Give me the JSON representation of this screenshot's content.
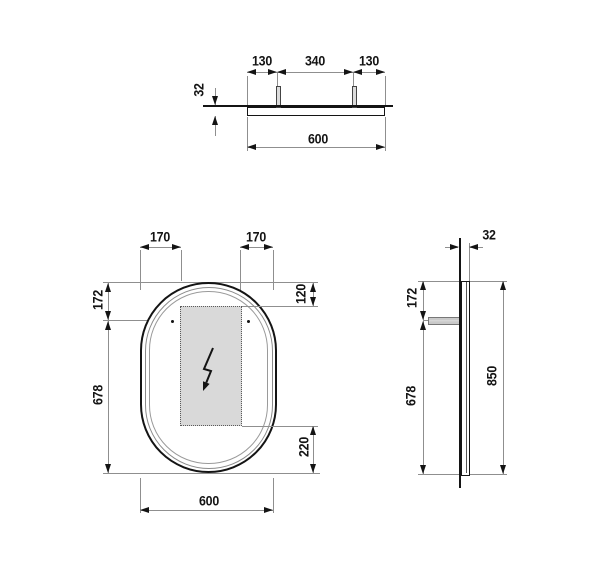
{
  "title": "Dimensional technical drawing — oval illuminated mirror, three orthographic views",
  "colors": {
    "outline": "#141414",
    "dim_line": "#8f8f8f",
    "light_zone_fill": "#d9d9d9",
    "background": "#ffffff"
  },
  "views": {
    "top": {
      "name": "top view",
      "dims": {
        "left_hanger_offset": "130",
        "hanger_spacing": "340",
        "right_hanger_offset": "130",
        "depth": "32",
        "width": "600"
      }
    },
    "front": {
      "name": "front view",
      "dims": {
        "left_inset": "170",
        "right_inset": "170",
        "top_to_hanger": "172",
        "hanger_to_bottom": "678",
        "top_to_lightzone": "120",
        "lightzone_to_bottom": "220",
        "width": "600"
      },
      "symbols": {
        "bolt": "electrical-connection"
      }
    },
    "side": {
      "name": "side view",
      "dims": {
        "depth": "32",
        "top_to_bracket": "172",
        "bracket_to_bottom": "678",
        "height": "850"
      }
    }
  }
}
